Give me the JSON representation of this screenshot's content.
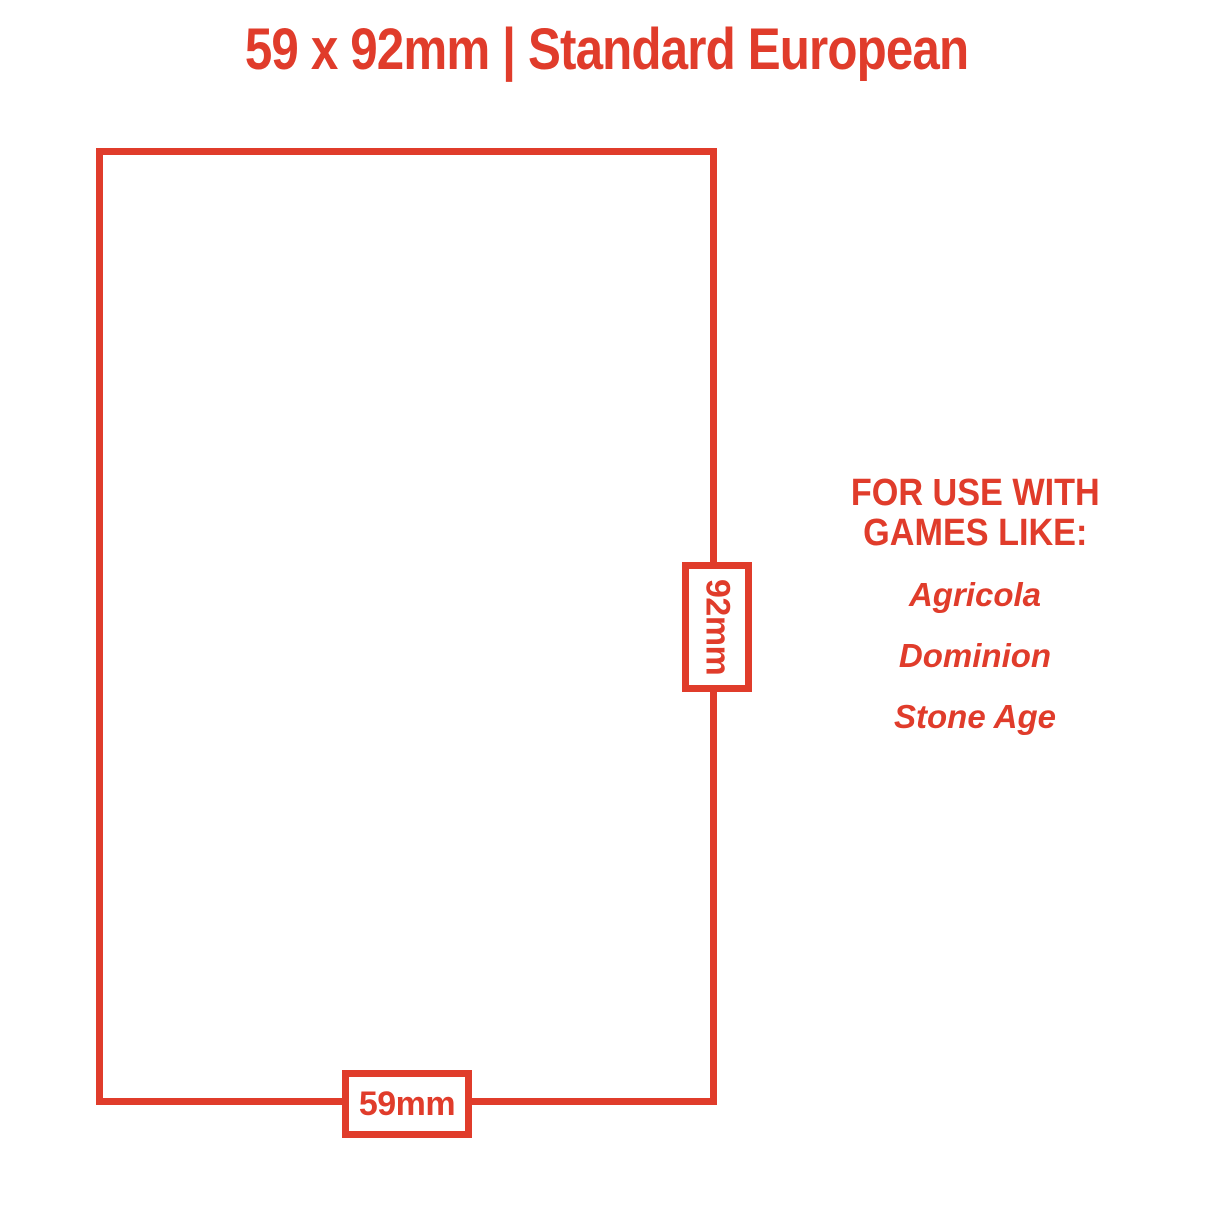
{
  "colors": {
    "accent": "#E03C2B",
    "background": "#FFFFFF"
  },
  "title": {
    "text": "59 x 92mm | Standard European"
  },
  "card_outline": {
    "height_label": "92mm",
    "width_label": "59mm"
  },
  "info_panel": {
    "heading_line1": "FOR USE WITH",
    "heading_line2": "GAMES LIKE:",
    "games": [
      "Agricola",
      "Dominion",
      "Stone Age"
    ]
  }
}
